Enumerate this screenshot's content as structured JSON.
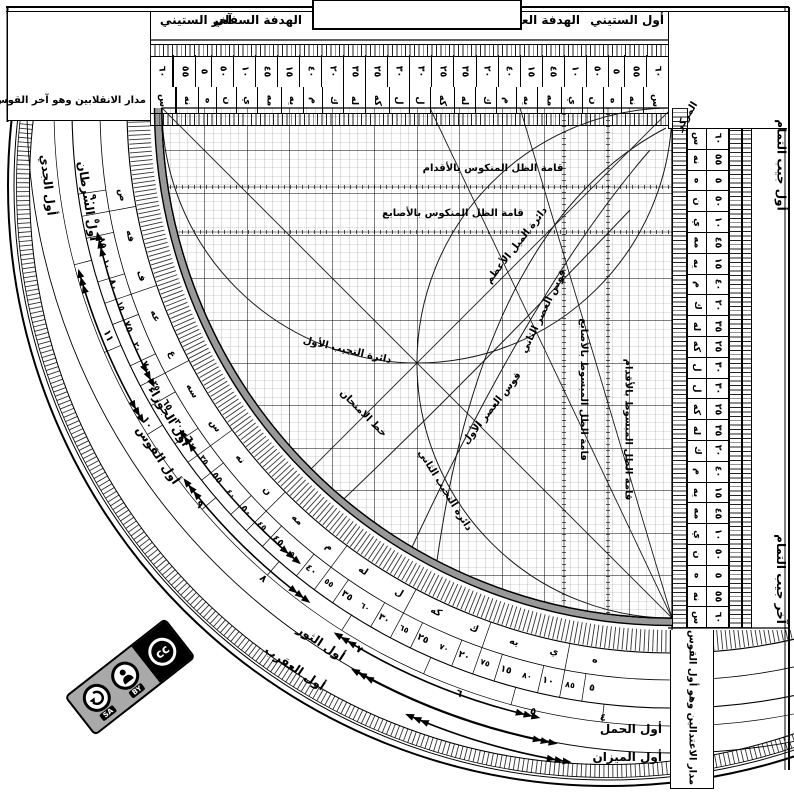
{
  "top_bar": {
    "awwal_sittini": "أول الستيني",
    "hadafa_ulya": "الهدفة العليا",
    "hadafa_sufla": "الهدفة السفلي",
    "akhir_sittini": "آخر الستيني"
  },
  "corner_label": "المركز",
  "top_left_note": "مدار الانقلابين وهو آخر القوس",
  "bottom_right_note": "مدار الاعتدالين وهو أول القوس",
  "right_edge": {
    "top": "أول جيب التمام",
    "bottom": "آخر جيب التمام"
  },
  "bottom_labels": {
    "hamal": "أول الحمل",
    "mizan": "أول الميزان"
  },
  "grid_labels": {
    "zill_mankus_aqdam": "قامة الظل المنكوس بالأقدام",
    "zill_mankus_asabi": "قامة الظل المنكوس بالأصابع",
    "mayl_azam": "دائرة الميل الأعظم",
    "asr_thani": "قوس العصر الثاني",
    "asr_awwal": "قوس العصر الأول",
    "tajyib_awwal": "دائرة التجيب الأول",
    "tajyib_thani": "دائرة التجيب الثاني",
    "khatt_imtihan": "خط الامتحان",
    "zill_mabsut_asabi": "قامة الظل المبسوط بالأصابع",
    "zill_mabsut_aqdam": "قامة الظل المبسوط بالأقدام"
  },
  "zodiac_labels": [
    {
      "id": "jady",
      "text": "أول الجدي"
    },
    {
      "id": "saratan",
      "text": "أول السرطان"
    },
    {
      "id": "jawza",
      "text": "أول الجوزاء"
    },
    {
      "id": "qaws",
      "text": "أول القوس"
    },
    {
      "id": "thawr",
      "text": "أول الثور"
    },
    {
      "id": "aqrab",
      "text": "أول العقرب"
    }
  ],
  "scales": {
    "sittini": {
      "numerals": [
        "٦٠",
        "٥٥",
        "٥",
        "٥٠",
        "١٠",
        "٤٥",
        "١٥",
        "٤٠",
        "٢٠",
        "٣٥",
        "٢٥",
        "٣٠",
        "٣٠",
        "٢٥",
        "٣٥",
        "٢٠",
        "٤٠",
        "١٥",
        "٤٥",
        "١٠",
        "٥٠",
        "٥",
        "٥٥",
        "٦٠"
      ],
      "abjad": [
        "س",
        "نه",
        "ه",
        "ن",
        "ي",
        "مه",
        "يه",
        "م",
        "ك",
        "له",
        "كه",
        "ل",
        "ل",
        "كه",
        "له",
        "ك",
        "م",
        "يه",
        "مه",
        "ي",
        "ن",
        "ه",
        "نه",
        "س"
      ]
    },
    "jayb": {
      "numerals": [
        "٦٠",
        "٥٥",
        "٥",
        "٥٠",
        "١٠",
        "٤٥",
        "١٥",
        "٤٠",
        "٢٠",
        "٣٥",
        "٢٥",
        "٣٠",
        "٣٠",
        "٢٥",
        "٣٥",
        "٢٠",
        "٤٠",
        "١٥",
        "٤٥",
        "١٠",
        "٥٠",
        "٥",
        "٥٥",
        "٦٠"
      ],
      "abjad": [
        "س",
        "نه",
        "ه",
        "ن",
        "ي",
        "مه",
        "يه",
        "م",
        "ك",
        "له",
        "كه",
        "ل",
        "ل",
        "كه",
        "له",
        "ك",
        "م",
        "يه",
        "مه",
        "ي",
        "ن",
        "ه",
        "نه",
        "س"
      ]
    },
    "arc": {
      "numerals": [
        "٩٠",
        "٨٥",
        "٨٠",
        "٧٥",
        "٧٠",
        "٦٥",
        "٦٠",
        "٥٥",
        "٥٠",
        "٤٥",
        "٤٠",
        "٣٥",
        "٣٠",
        "٢٥",
        "٢٠",
        "١٥",
        "١٠",
        "٥"
      ],
      "abjad": [
        "ص",
        "فه",
        "ف",
        "عه",
        "ع",
        "سه",
        "س",
        "نه",
        "ن",
        "مه",
        "م",
        "له",
        "ل",
        "كه",
        "ك",
        "يه",
        "ي",
        "ه"
      ],
      "asc": [
        "٥",
        "١٠",
        "١٥",
        "٢٠",
        "٢٥",
        "٣٠",
        "٣٥",
        "٤٠",
        "٤٥",
        "٥٠",
        "٥٥",
        "٦٠",
        "٦٥",
        "٧٠",
        "٧٥",
        "٨٠",
        "٨٥"
      ],
      "hours": [
        "١١",
        "١٠",
        "٩",
        "٨",
        "٧",
        "٦",
        "٥",
        "٤"
      ]
    }
  },
  "license": {
    "name": "CC BY-SA",
    "cc": "cc",
    "by": "BY",
    "sa": "SA"
  },
  "colors": {
    "ink": "#000000",
    "band_gray": "#999999",
    "badge_gray": "#a9a9a9"
  }
}
